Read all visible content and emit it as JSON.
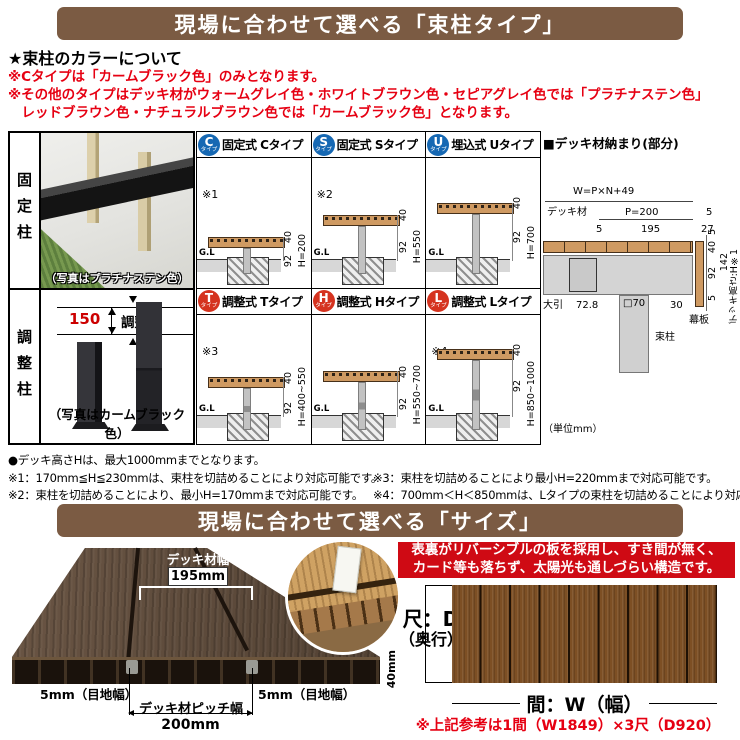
{
  "banners": {
    "type_title": "現場に合わせて選べる「束柱タイプ」",
    "size_title": "現場に合わせて選べる「サイズ」"
  },
  "color_section": {
    "heading": "★束柱のカラーについて",
    "line1": "※Cタイプは「カームブラック色」のみとなります。",
    "line2": "※その他のタイプはデッキ材がウォームグレイ色・ホワイトブラウン色・セピアグレイ色では「プラチナステン色」",
    "line3": "　レッドブラウン色・ナチュラルブラウン色では「カームブラック色」となります。"
  },
  "panels": {
    "fixed": {
      "label": "固定柱",
      "caption": "（写真はプラチナステン色）"
    },
    "adjustable": {
      "label": "調整柱",
      "caption": "（写真はカームブラック色）",
      "adjust_value": "150",
      "adjust_word": "調整"
    }
  },
  "cells": [
    {
      "letter": "C",
      "badge_sub": "タイプ",
      "title": "固定式 Cタイプ",
      "note": "※1",
      "gl": "G.L",
      "d40": "40",
      "d92": "92",
      "h": "H=200"
    },
    {
      "letter": "S",
      "badge_sub": "タイプ",
      "title": "固定式 Sタイプ",
      "note": "※2",
      "gl": "G.L",
      "d40": "40",
      "d92": "92",
      "h": "H=550"
    },
    {
      "letter": "U",
      "badge_sub": "タイプ",
      "title": "埋込式 Uタイプ",
      "note": "",
      "gl": "G.L",
      "d40": "40",
      "d92": "92",
      "h": "H=700"
    },
    {
      "letter": "T",
      "badge_sub": "タイプ",
      "title": "調整式 Tタイプ",
      "note": "※3",
      "gl": "G.L",
      "d40": "40",
      "d92": "92",
      "h": "H=400~550"
    },
    {
      "letter": "H",
      "badge_sub": "タイプ",
      "title": "調整式 Hタイプ",
      "note": "",
      "gl": "G.L",
      "d40": "40",
      "d92": "92",
      "h": "H=550~700"
    },
    {
      "letter": "L",
      "badge_sub": "タイプ",
      "title": "調整式 Lタイプ",
      "note": "※4",
      "gl": "G.L",
      "d40": "40",
      "d92": "92",
      "h": "H=850~1000"
    }
  ],
  "detail": {
    "title": "■デッキ材納まり(部分)",
    "w_formula": "W=P×N+49",
    "deck_label": "デッキ材",
    "p200": "P=200",
    "five_right": "5",
    "five_left": "5",
    "v195": "195",
    "v27": "27",
    "d5a": "5",
    "d40": "40",
    "d92": "92",
    "d142": "142",
    "d5b": "5",
    "ohiki": "大引",
    "v728": "72.8",
    "post_size": "□70",
    "tsuka": "束柱",
    "v30": "30",
    "makiita": "幕板",
    "deck_height": "デッキ高さ:H※1",
    "unit": "（単位mm）"
  },
  "notes": {
    "main": "●デッキ高さHは、最大1000mmまでとなります。",
    "n1": "※1：170mm≦H≦230mmは、束柱を切詰めることにより対応可能です。",
    "n2": "※2：束柱を切詰めることにより、最小H=170mmまで対応可能です。",
    "n3": "※3：束柱を切詰めることにより最小H=220mmまで対応可能です。",
    "n4": "※4：700mm＜H＜850mmは、Lタイプの束柱を切詰めることにより対応可能です。"
  },
  "size_section": {
    "board_width_label": "デッキ材幅",
    "board_width_value": "195mm",
    "joint_left": "5mm（目地幅）",
    "joint_right": "5mm（目地幅）",
    "thickness": "40mm",
    "pitch_label": "デッキ材ピッチ幅",
    "pitch_value": "200mm",
    "feature_line1": "表裏がリバーシブルの板を採用し、すき間が無く、",
    "feature_line2": "カード等も落ちず、太陽光も通しづらい構造です。",
    "depth_label_1": "尺：D",
    "depth_label_2": "（奥行）",
    "width_label": "間：W（幅）",
    "ref_note": "※上記参考は1間（W1849）×3尺（D920）"
  },
  "colors": {
    "banner_brown": "#7b5b43",
    "note_red": "#e60012",
    "badge_blue": "#1668b3",
    "badge_red": "#d5331f",
    "deck_wood": "#cf9a62"
  }
}
